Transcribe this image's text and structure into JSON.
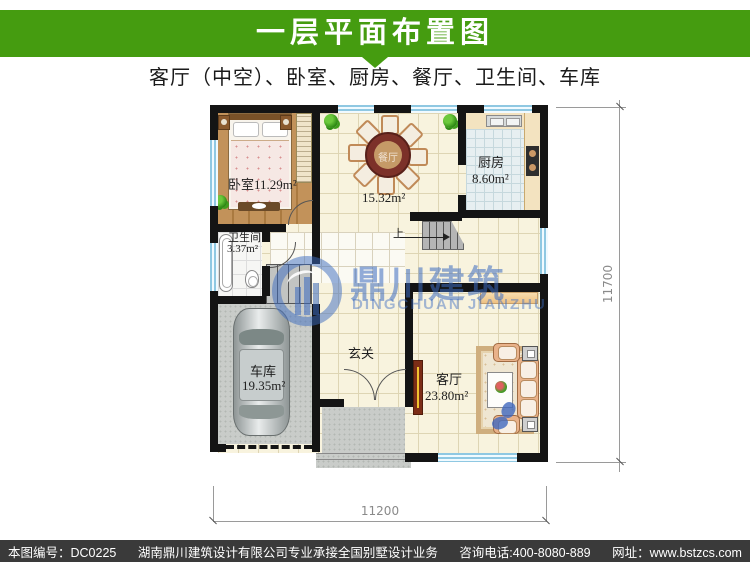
{
  "colors": {
    "accent_green": "#459c10",
    "watermark_blue": "#3a6ac0",
    "footer_bg": "#3a3a3a",
    "wall_black": "#141414",
    "window_blue": "#8fc8e2"
  },
  "header": {
    "title": "一层平面布置图",
    "subtitle": "客厅（中空）、卧室、厨房、餐厅、卫生间、车库"
  },
  "plan": {
    "rooms": {
      "bedroom": {
        "label": "卧室11.29m²"
      },
      "dining": {
        "label": "餐厅",
        "area": "15.32m²"
      },
      "kitchen": {
        "label": "厨房",
        "area": "8.60m²"
      },
      "bathroom": {
        "label": "卫生间",
        "area": "3.37m²"
      },
      "garage": {
        "label": "车库",
        "area": "19.35m²"
      },
      "hall": {
        "label": "玄关"
      },
      "living": {
        "label": "客厅",
        "area": "23.80m²"
      }
    },
    "stairs": {
      "up_label": "上"
    },
    "dimensions": {
      "width": "11200",
      "height": "11700"
    }
  },
  "watermark": {
    "cn": "鼎川建筑",
    "en": "DINGCHUAN JIANZHU"
  },
  "footer": {
    "serial": "本图编号：DC0225",
    "company": "湖南鼎川建筑设计有限公司专业承接全国别墅设计业务",
    "phone": "咨询电话:400-8080-889",
    "website": "网址：www.bstzcs.com"
  }
}
